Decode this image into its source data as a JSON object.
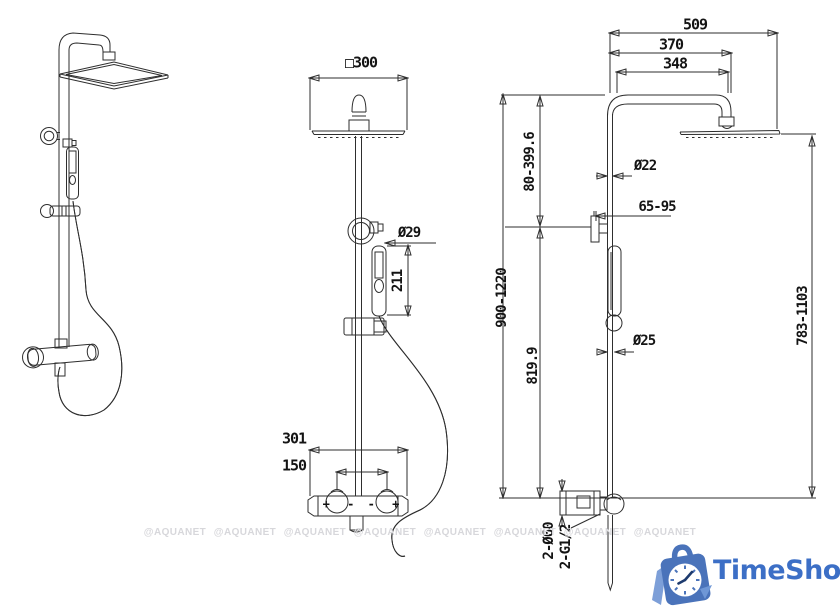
{
  "drawing": {
    "front_view": {
      "head_size": "□300",
      "hand_shower_diameter": "Ø29",
      "hand_shower_length": "211",
      "mixer_width": "301",
      "handle_spacing": "150",
      "left_handle_marks": "+ -",
      "right_handle_marks": "- +"
    },
    "side_view": {
      "overall_depth": "509",
      "arm_reach": "370",
      "arm_length": "348",
      "head_height_adjust": "80-399.6",
      "riser_diameter": "Ø22",
      "wall_bracket_depth": "65-95",
      "overall_height": "900-1220",
      "riser_height": "819.9",
      "slider_diameter": "Ø25",
      "head_to_base_height": "783-1103",
      "escutcheon_size": "2-Ø60",
      "connection_thread": "2-G1/2"
    }
  },
  "watermark": {
    "text": "@AQUANET"
  },
  "logo": {
    "text": "TimeShop"
  },
  "colors": {
    "line": "#2e2e2e",
    "dimension_text": "#141414",
    "watermark": "#d7d7db",
    "logo_blue": "#3c6fc6",
    "logo_bag": "#4a73ba",
    "logo_stripe": "#7d9fd8"
  }
}
